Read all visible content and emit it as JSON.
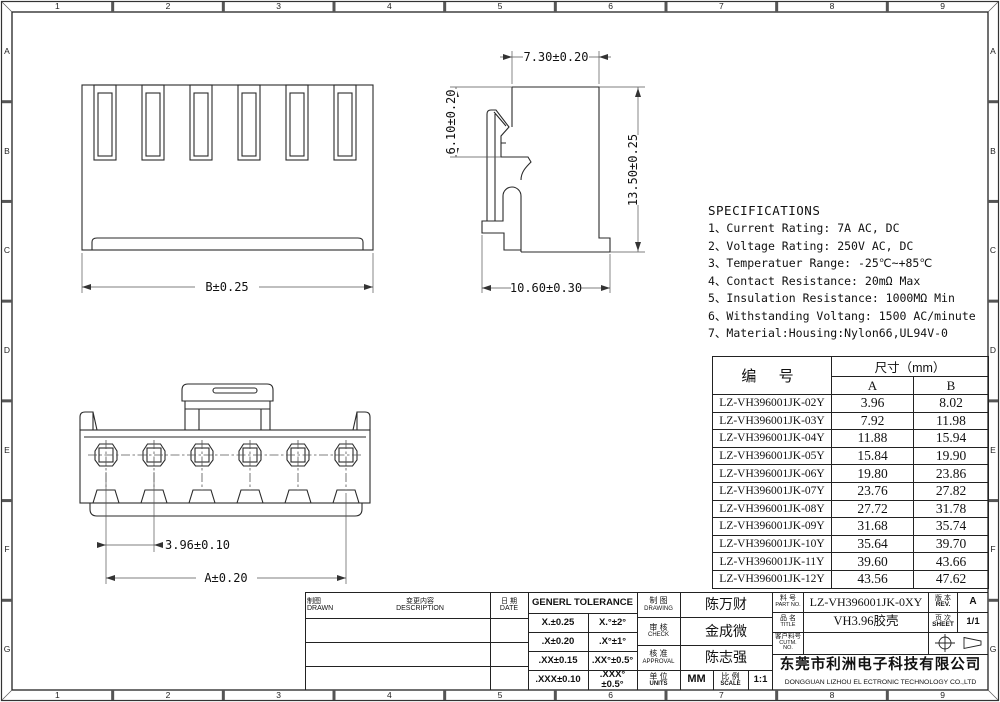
{
  "zones": {
    "columns": [
      "1",
      "2",
      "3",
      "4",
      "5",
      "6",
      "7",
      "8",
      "9"
    ],
    "rows": [
      "A",
      "B",
      "C",
      "D",
      "E",
      "F",
      "G"
    ]
  },
  "specifications": {
    "title": "SPECIFICATIONS",
    "lines": [
      "1、Current Rating: 7A AC, DC",
      "2、Voltage Rating: 250V AC, DC",
      "3、Temperatuer Range: -25℃~+85℃",
      "4、Contact Resistance: 20mΩ Max",
      "5、Insulation Resistance: 1000MΩ Min",
      "6、Withstanding Voltang: 1500 AC/minute",
      "7、Material:Housing:Nylon66,UL94V-0"
    ]
  },
  "dims": {
    "front_width": "B±0.25",
    "side_top": "7.30±0.20",
    "side_left": "6.10±0.20",
    "side_right": "13.50±0.25",
    "side_bottom": "10.60±0.30",
    "pitch": "3.96±0.10",
    "overall_a": "A±0.20"
  },
  "parts_table": {
    "header_part": "编 号",
    "header_dim": "尺寸（mm）",
    "header_a": "A",
    "header_b": "B",
    "rows": [
      {
        "part": "LZ-VH396001JK-02Y",
        "a": "3.96",
        "b": "8.02"
      },
      {
        "part": "LZ-VH396001JK-03Y",
        "a": "7.92",
        "b": "11.98"
      },
      {
        "part": "LZ-VH396001JK-04Y",
        "a": "11.88",
        "b": "15.94"
      },
      {
        "part": "LZ-VH396001JK-05Y",
        "a": "15.84",
        "b": "19.90"
      },
      {
        "part": "LZ-VH396001JK-06Y",
        "a": "19.80",
        "b": "23.86"
      },
      {
        "part": "LZ-VH396001JK-07Y",
        "a": "23.76",
        "b": "27.82"
      },
      {
        "part": "LZ-VH396001JK-08Y",
        "a": "27.72",
        "b": "31.78"
      },
      {
        "part": "LZ-VH396001JK-09Y",
        "a": "31.68",
        "b": "35.74"
      },
      {
        "part": "LZ-VH396001JK-10Y",
        "a": "35.64",
        "b": "39.70"
      },
      {
        "part": "LZ-VH396001JK-11Y",
        "a": "39.60",
        "b": "43.66"
      },
      {
        "part": "LZ-VH396001JK-12Y",
        "a": "43.56",
        "b": "47.62"
      }
    ]
  },
  "title_block": {
    "drawn_cn": "制图",
    "drawn_en": "DRAWN",
    "description_cn": "变更内容",
    "description_en": "DESCRIPTION",
    "date_cn": "日 期",
    "date_en": "DATE",
    "tolerance_title": "GENERL  TOLERANCE",
    "tolerance_rows": [
      {
        "lin": "X.±0.25",
        "ang": "X.°±2°"
      },
      {
        "lin": ".X±0.20",
        "ang": ".X°±1°"
      },
      {
        "lin": ".XX±0.15",
        "ang": ".XX°±0.5°"
      },
      {
        "lin": ".XXX±0.10",
        "ang": ".XXX°±0.5°"
      }
    ],
    "drawing_cn": "制 图",
    "drawing_en": "DRAWING",
    "drawing_name": "陈万财",
    "check_cn": "审 核",
    "check_en": "CHECK",
    "check_name": "金成微",
    "approval_cn": "核 准",
    "approval_en": "APPROVAL",
    "approval_name": "陈志强",
    "units_cn": "单 位",
    "units_en": "UNITS",
    "units_value": "MM",
    "scale_cn": "比 例",
    "scale_en": "SCALE",
    "scale_value": "1:1",
    "part_no_cn": "料 号",
    "part_no_en": "PART NO.",
    "part_no_value": "LZ-VH396001JK-0XY",
    "rev_cn": "版 本",
    "rev_en": "REV.",
    "rev_value": "A",
    "title_cn": "品 名",
    "title_en": "TITLE",
    "title_value": "VH3.96胶壳",
    "sheet_cn": "页 次",
    "sheet_en": "SHEET",
    "sheet_value": "1/1",
    "customer_cn": "客户料号",
    "customer_en": "CUTM. NO.",
    "company_cn": "东莞市利洲电子科技有限公司",
    "company_en": "DONGGUAN LIZHOU EL ECTRONIC TECHNOLOGY CO.,LTD"
  }
}
